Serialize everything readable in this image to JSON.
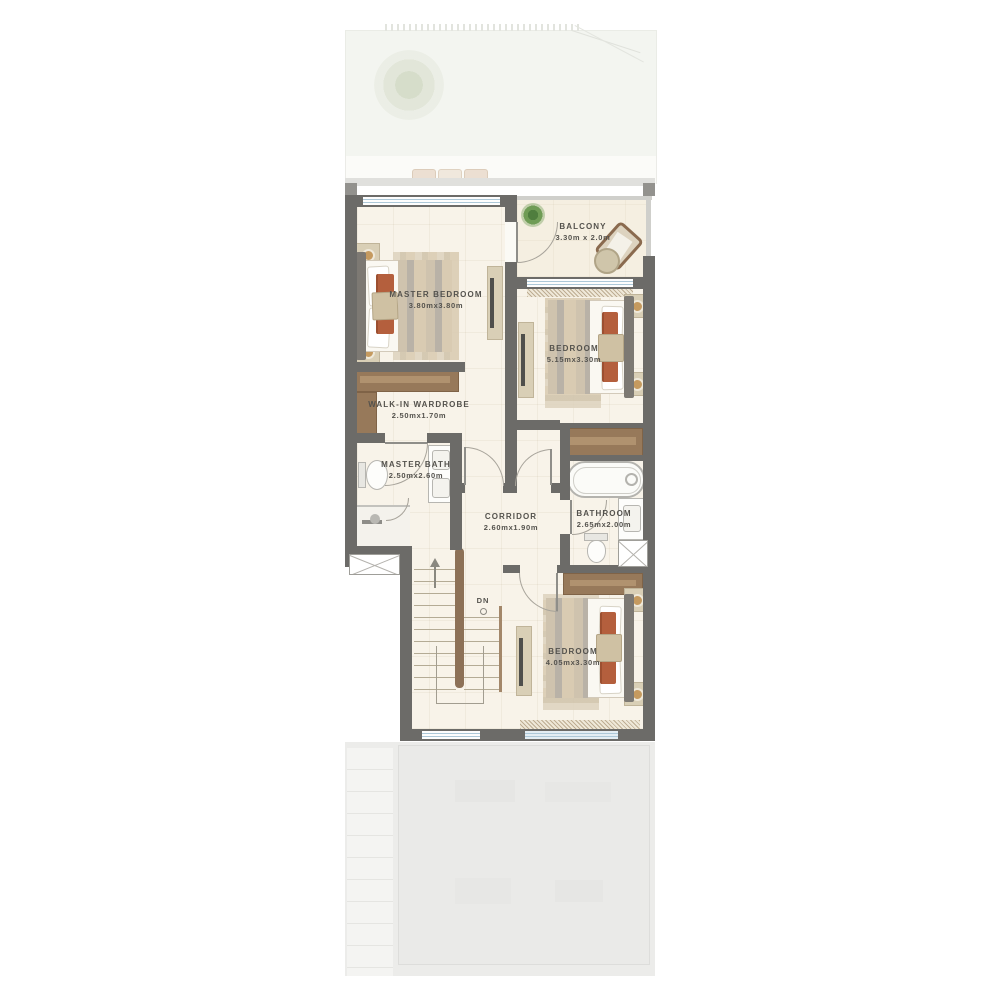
{
  "plan": {
    "type": "floor-plan",
    "level": "first-floor",
    "rooms": [
      {
        "id": "master-bedroom",
        "name": "MASTER BEDROOM",
        "dims": "3.80mx3.80m"
      },
      {
        "id": "balcony",
        "name": "BALCONY",
        "dims": "3.30m x 2.0m"
      },
      {
        "id": "bedroom-2",
        "name": "BEDROOM",
        "dims": "5.15mx3.30m"
      },
      {
        "id": "walk-in-wardrobe",
        "name": "WALK-IN WARDROBE",
        "dims": "2.50mx1.70m"
      },
      {
        "id": "master-bath",
        "name": "MASTER BATH",
        "dims": "2.50mx2.60m"
      },
      {
        "id": "corridor",
        "name": "CORRIDOR",
        "dims": "2.60mx1.90m"
      },
      {
        "id": "bathroom",
        "name": "BATHROOM",
        "dims": "2.65mx2.00m"
      },
      {
        "id": "bedroom-3",
        "name": "BEDROOM",
        "dims": "4.05mx3.30m"
      }
    ],
    "stairs": {
      "label": "DN"
    },
    "palette": {
      "wall": "#6c6b68",
      "floor": "#f8f3e9",
      "balcony_floor": "#f5efe1",
      "wood": "#97795a",
      "accent_rust": "#b45f3d",
      "window_line": "#adc8d8",
      "ghost_area": "#ececea",
      "label_text": "#54524d"
    }
  }
}
